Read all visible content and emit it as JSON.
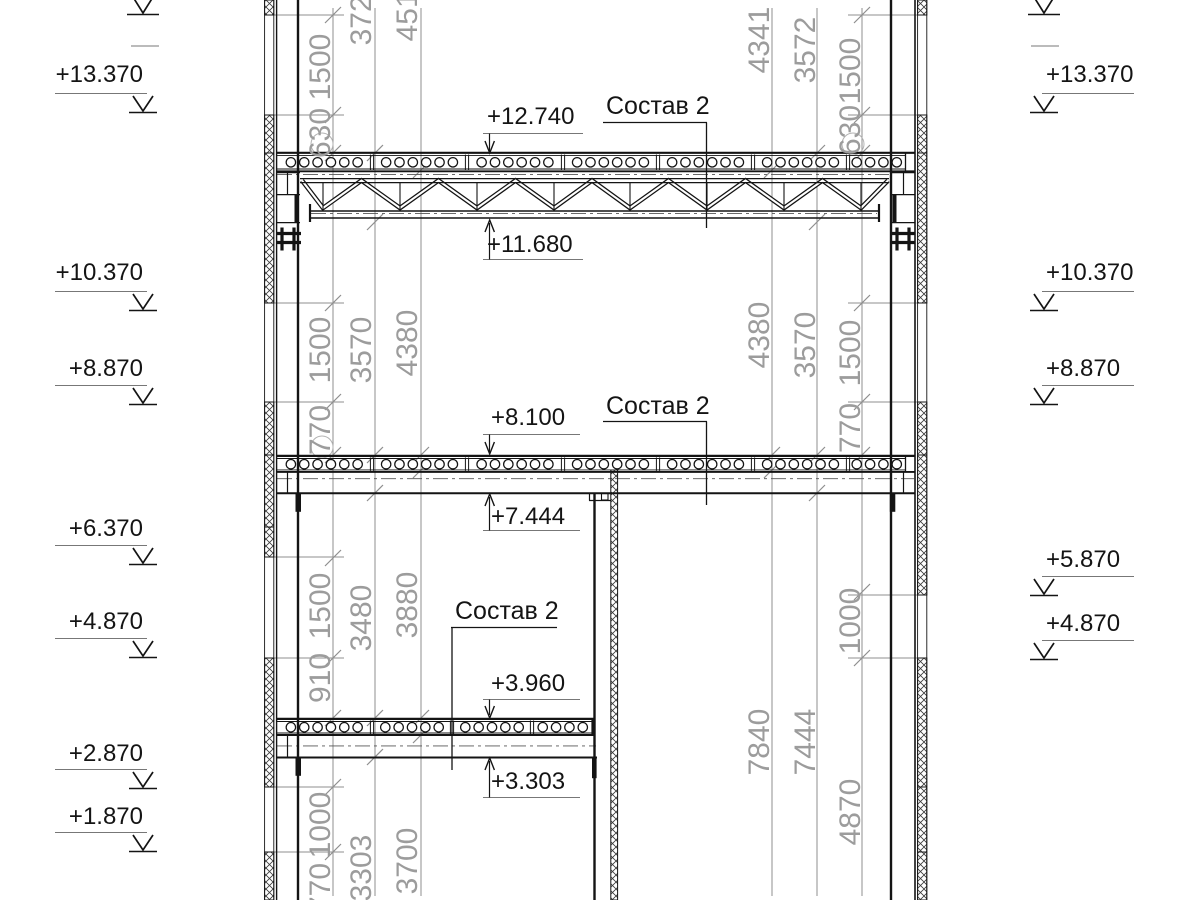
{
  "drawing": {
    "type": "structural-section",
    "units_note": ""
  },
  "elevations_left": [
    "+13.370",
    "+10.370",
    "+8.870",
    "+6.370",
    "+4.870",
    "+2.870",
    "+1.870"
  ],
  "elevations_right": [
    "+13.370",
    "+10.370",
    "+8.870",
    "+5.870",
    "+4.870"
  ],
  "callouts": {
    "floor3": {
      "top": "+12.740",
      "composition": "Состав 2",
      "bottom": "+11.680"
    },
    "floor2": {
      "top": "+8.100",
      "composition": "Состав 2",
      "bottom": "+7.444"
    },
    "floor1": {
      "composition": "Состав 2",
      "top": "+3.960",
      "bottom": "+3.303"
    }
  },
  "dimensions": {
    "left_wall_chain": [
      "1500",
      "630",
      "1500",
      "770",
      "1500",
      "910",
      "1000",
      "770"
    ],
    "left_room_chain": [
      "3724",
      "3570",
      "3480",
      "3303"
    ],
    "left_span_chain": [
      "4516",
      "4380",
      "3880",
      "3700"
    ],
    "right_wall_chain": [
      "1500",
      "630",
      "1500",
      "770",
      "1000",
      "4870"
    ],
    "right_room_chain": [
      "3572",
      "3570",
      "7444"
    ],
    "right_span_chain": [
      "4341",
      "4380",
      "7840"
    ]
  },
  "colors": {
    "line": "#141414",
    "dim_gray": "#9c9c9c",
    "background": "#ffffff"
  }
}
